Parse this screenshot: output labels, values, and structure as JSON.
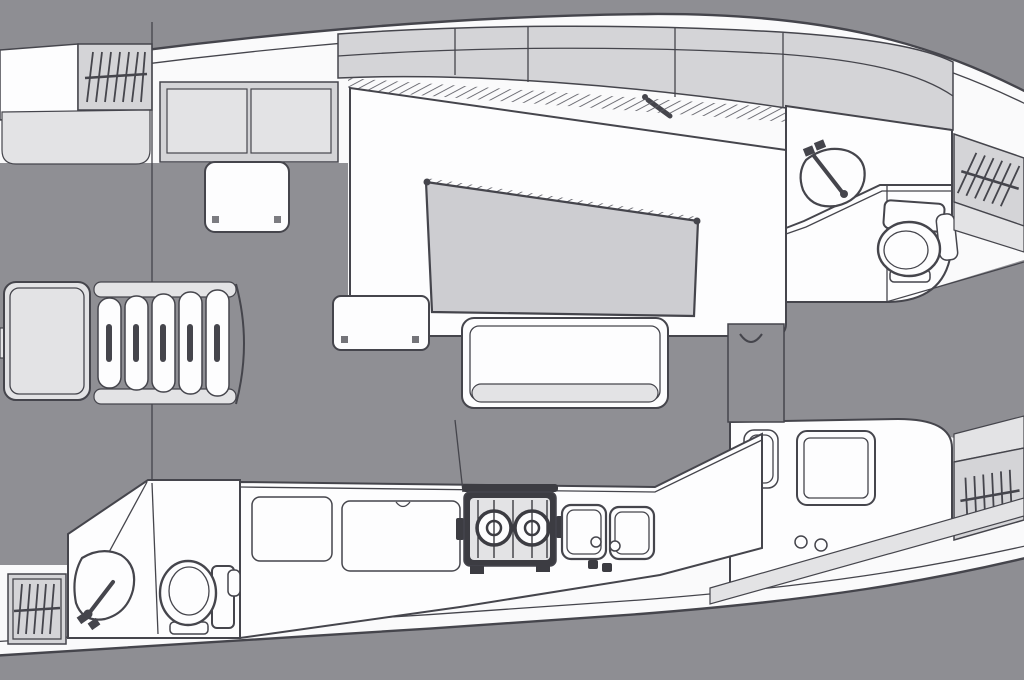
{
  "canvas": {
    "width": 1024,
    "height": 680
  },
  "palette": {
    "background": "#8e8e93",
    "floor": "#8f8f94",
    "hull": "#fafafb",
    "outline": "#45454c",
    "furniture": "#d4d4d7",
    "shelf": "#e3e3e5",
    "table": "#cdcdd1",
    "white": "#fdfdfe",
    "stove": "#3c3c42"
  },
  "diagram": {
    "type": "yacht-interior-floor-plan",
    "orientation": {
      "bow": "right",
      "stern": "left"
    },
    "rooms": [
      {
        "id": "aft-cabin",
        "area": "top-left",
        "fixtures": [
          "hanging-locker",
          "storage-cabinet-two-doors",
          "shelf",
          "seat-table"
        ]
      },
      {
        "id": "companionway",
        "area": "left-middle",
        "fixtures": [
          "five-step-ladder",
          "engine-box"
        ]
      },
      {
        "id": "salon",
        "area": "center",
        "fixtures": [
          "side-shelf-band",
          "u-settee",
          "dining-table",
          "bench-seat",
          "door-handle"
        ]
      },
      {
        "id": "galley",
        "area": "bottom-center",
        "fixtures": [
          "locker-lid",
          "fridge-lid",
          "two-burner-gimbal-stove",
          "double-sink",
          "counter"
        ]
      },
      {
        "id": "aft-head",
        "area": "bottom-left",
        "fixtures": [
          "shower-partition",
          "wash-basin",
          "marine-toilet",
          "hanging-locker"
        ]
      },
      {
        "id": "forward-head",
        "area": "top-right",
        "fixtures": [
          "vanity-counter",
          "wash-basin",
          "marine-toilet"
        ]
      },
      {
        "id": "nav-station",
        "area": "bottom-right",
        "fixtures": [
          "seat",
          "chart-table",
          "instrument-knobs",
          "partition-cabinet"
        ]
      },
      {
        "id": "forward-cabin",
        "area": "right",
        "fixtures": [
          "hanging-locker-top",
          "hanging-locker-bottom",
          "shelf-bands"
        ]
      }
    ]
  }
}
